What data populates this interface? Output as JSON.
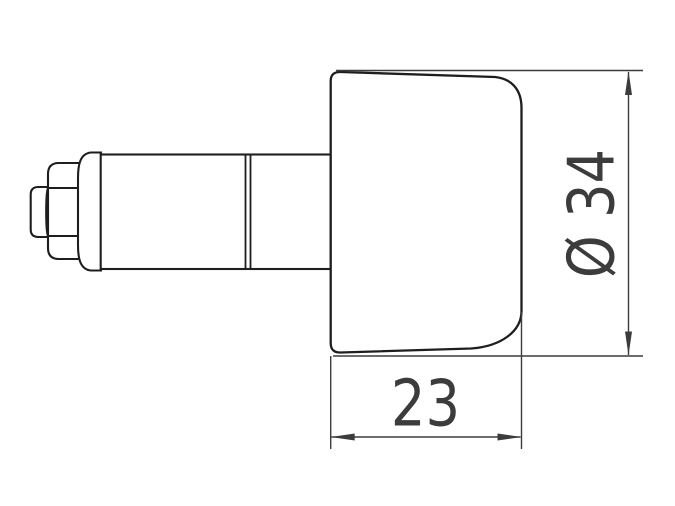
{
  "colors": {
    "line": "#1e1e1e",
    "dim_line": "#3c3c3c",
    "bg": "#ffffff"
  },
  "diagram": {
    "dim_diameter_label": "Ø 34",
    "dim_width_label": "23"
  }
}
